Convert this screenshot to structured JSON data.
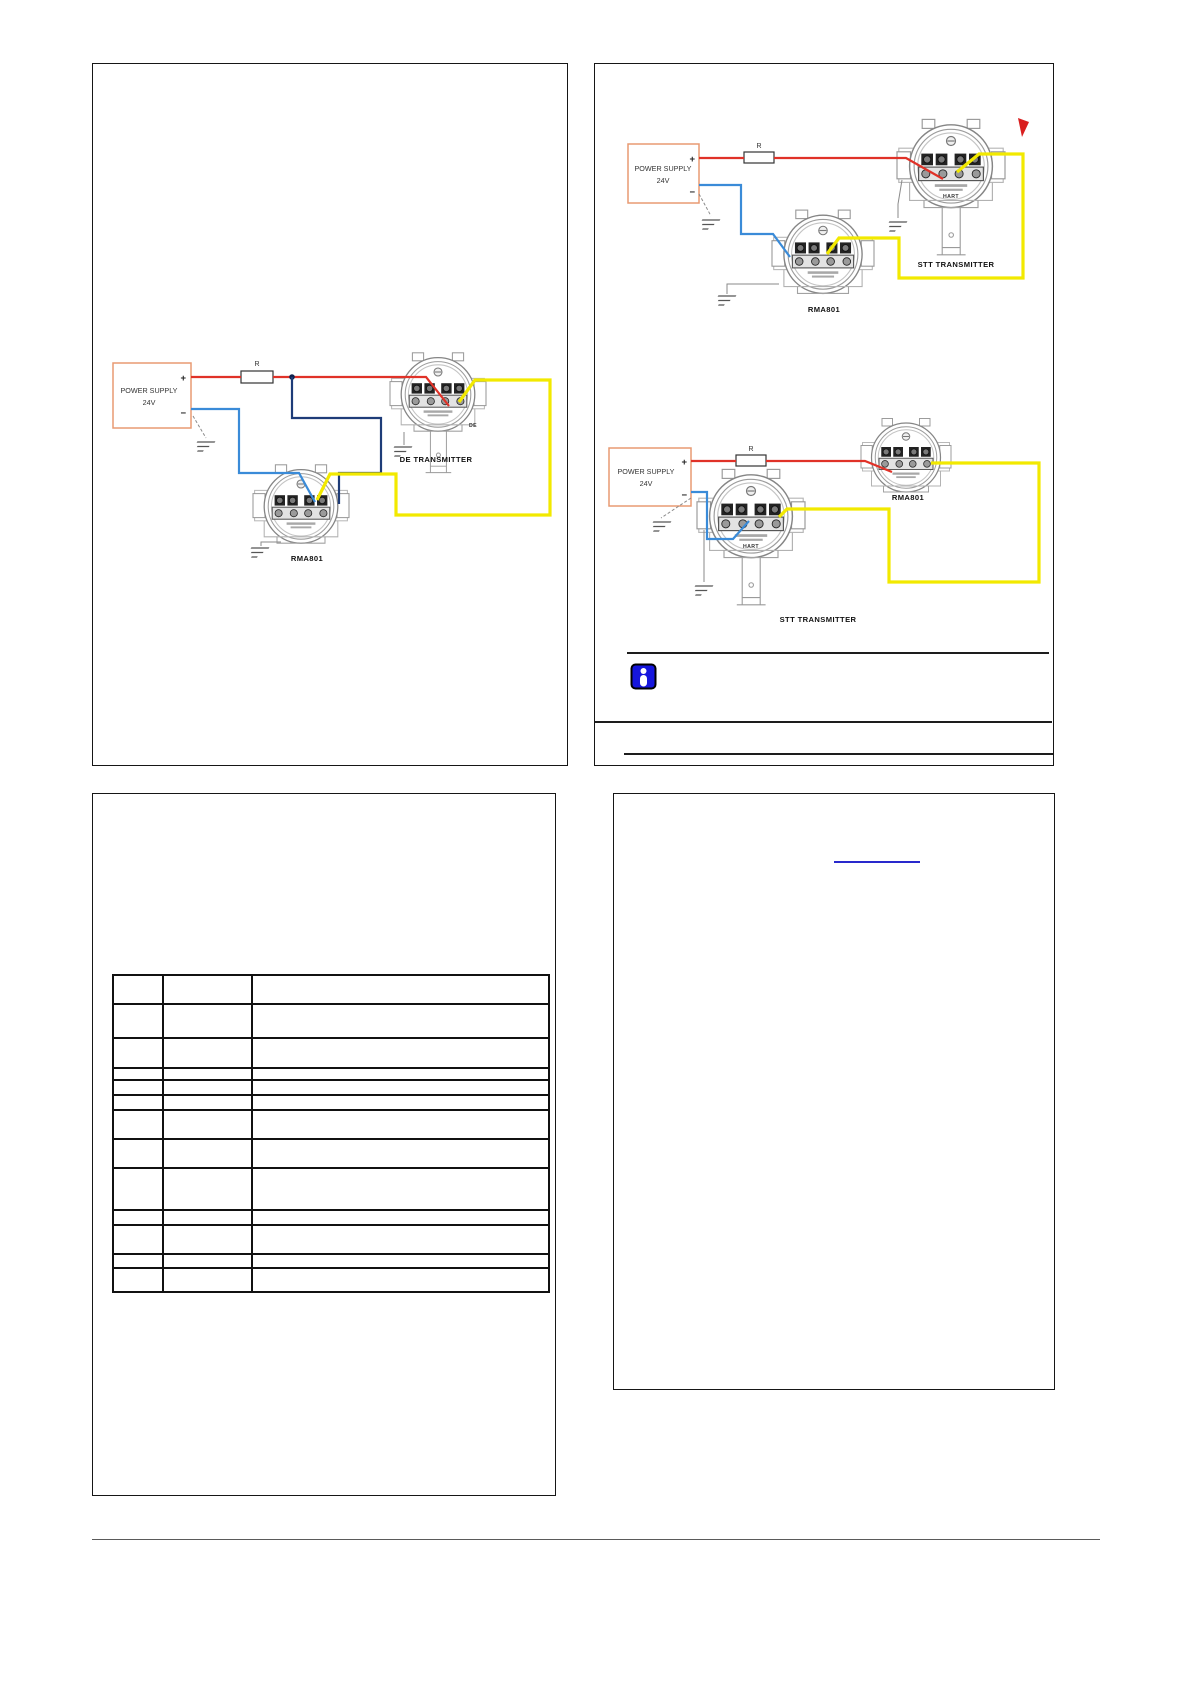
{
  "colors": {
    "panel_border": "#161616",
    "wire_red": "#e03228",
    "wire_blue": "#3a8bd8",
    "wire_navy": "#1e3c78",
    "wire_yellow": "#f2e900",
    "power_box": "#e89a72",
    "info_icon_blue": "#1616dd",
    "link_blue": "#2929cc",
    "revision_red": "#d91f1f"
  },
  "diagrams": {
    "de": {
      "ps_line1": "POWER SUPPLY",
      "ps_line2": "24V",
      "resistor": "R",
      "plus": "+",
      "minus": "−",
      "transmitter": "DE TRANSMITTER",
      "transmitter_tag": "DE",
      "monitor": "RMA801"
    },
    "stt_top": {
      "ps_line1": "POWER SUPPLY",
      "ps_line2": "24V",
      "resistor": "R",
      "plus": "+",
      "minus": "−",
      "transmitter": "STT TRANSMITTER",
      "transmitter_tag": "HART",
      "monitor": "RMA801"
    },
    "stt_bottom": {
      "ps_line1": "POWER SUPPLY",
      "ps_line2": "24V",
      "resistor": "R",
      "plus": "+",
      "minus": "−",
      "transmitter": "STT TRANSMITTER",
      "transmitter_tag": "HART",
      "monitor": "RMA801"
    }
  },
  "table": {
    "rows": [
      [
        "",
        "",
        ""
      ],
      [
        "",
        "",
        ""
      ],
      [
        "",
        "",
        ""
      ],
      [
        "",
        "",
        ""
      ],
      [
        "",
        "",
        ""
      ],
      [
        "",
        "",
        ""
      ],
      [
        "",
        "",
        ""
      ],
      [
        "",
        "",
        ""
      ],
      [
        "",
        "",
        ""
      ],
      [
        "",
        "",
        ""
      ],
      [
        "",
        "",
        ""
      ],
      [
        "",
        "",
        ""
      ],
      [
        "",
        "",
        ""
      ]
    ]
  },
  "link": {
    "text": ""
  }
}
